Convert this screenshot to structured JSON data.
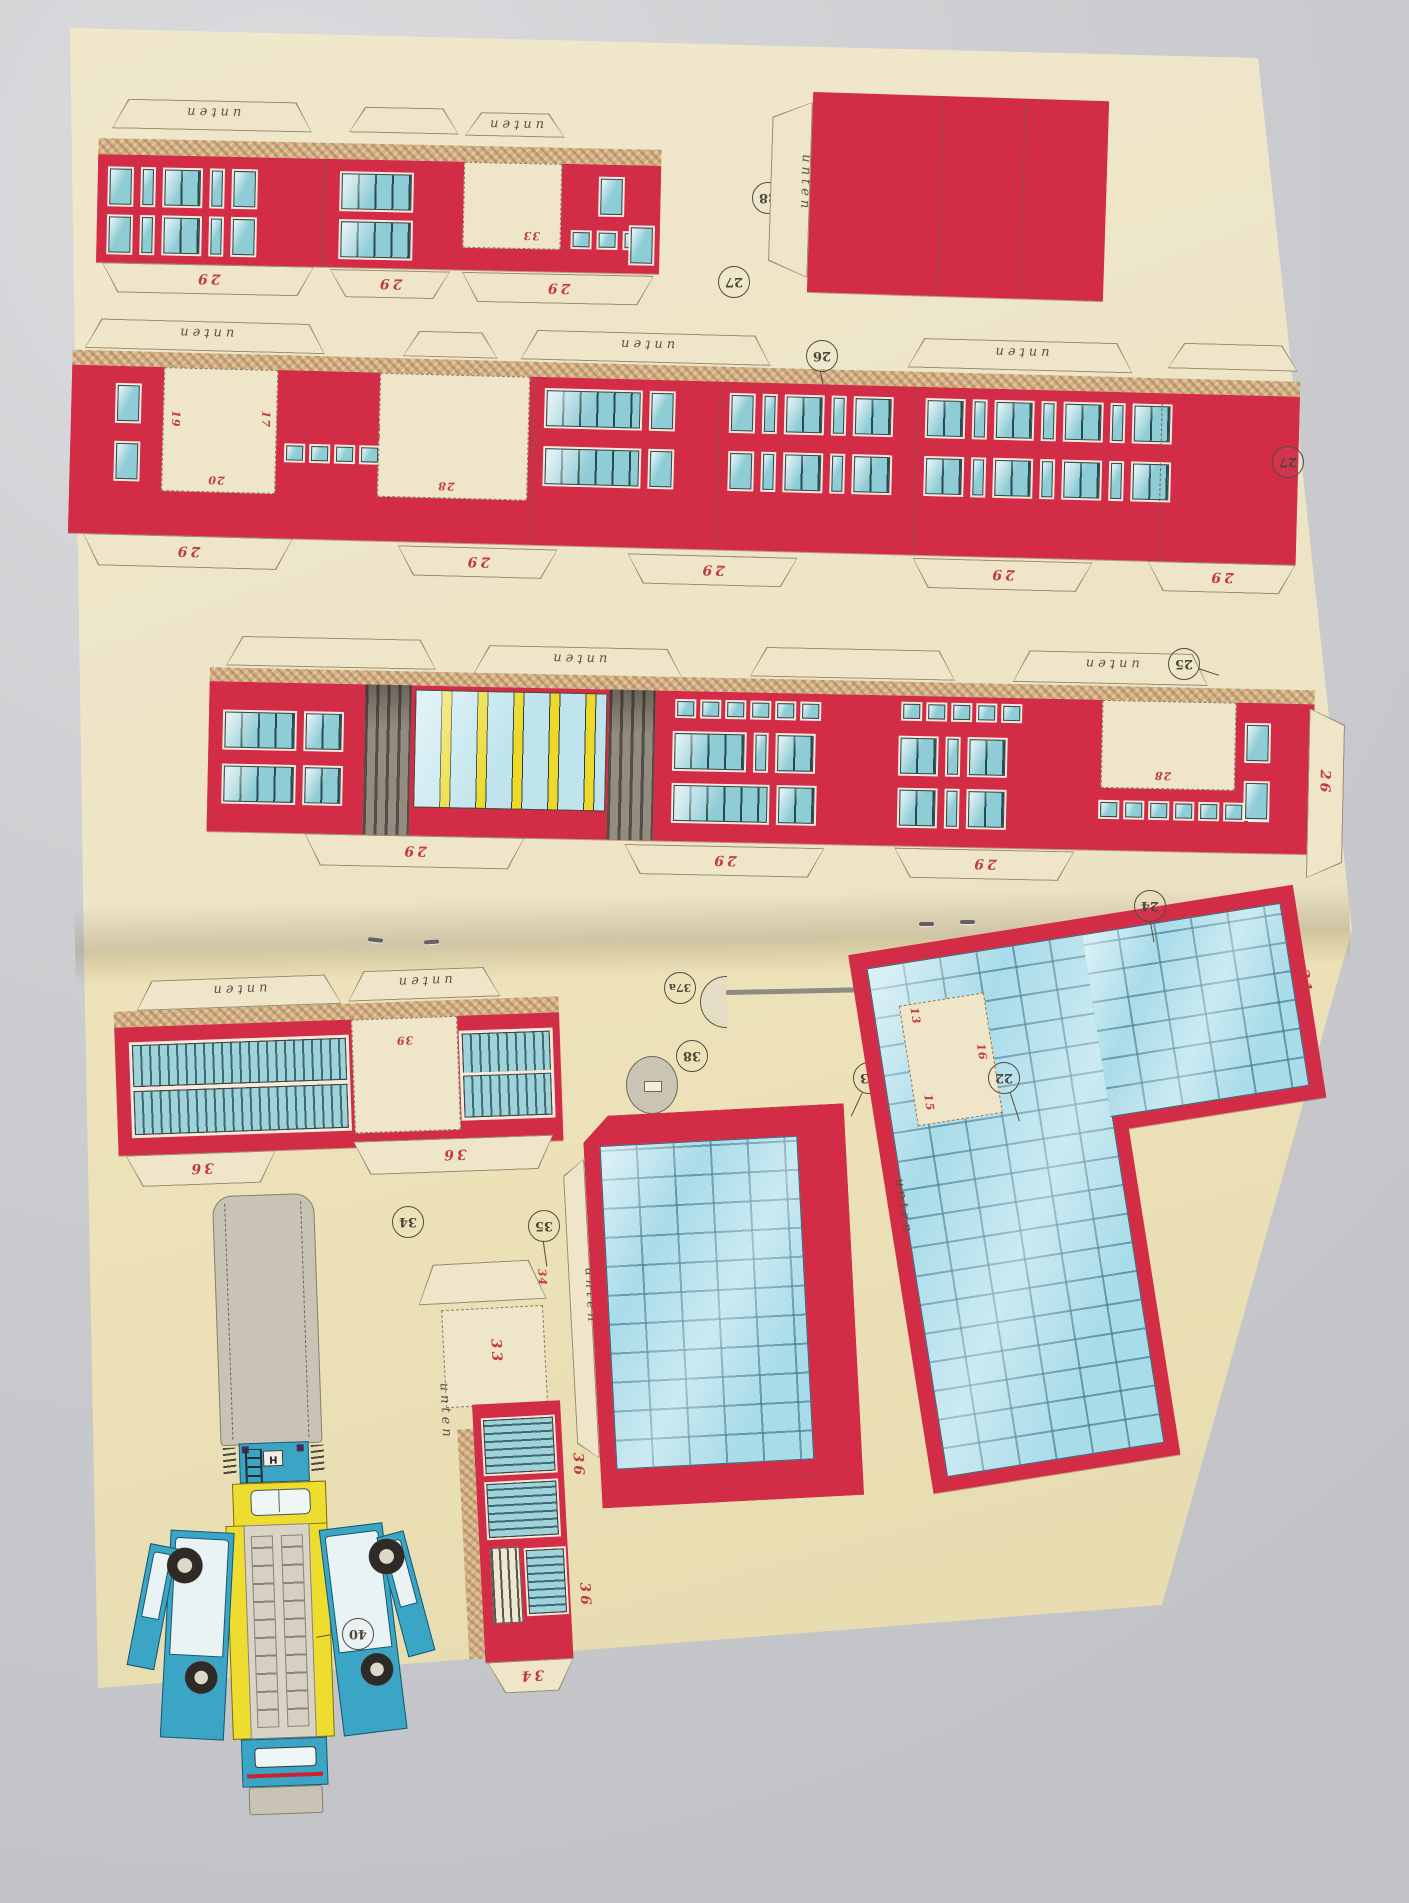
{
  "sheet": {
    "kind": "paper model cut-out sheet (booklet, two pages, stapled fold)",
    "labels": {
      "unten": "unten",
      "h_sign": "H",
      "n13": "13",
      "n15": "15",
      "n16": "16",
      "n17": "17",
      "n19": "19",
      "n20": "20",
      "n21": "21",
      "n22": "22",
      "n23": "23",
      "n24": "24",
      "n25": "25",
      "n26": "26",
      "n27": "27",
      "n28": "28",
      "n29": "29",
      "n33": "33",
      "n34": "34",
      "n35": "35",
      "n36": "36",
      "n37a": "37a",
      "n37A": "37A",
      "n37b": "37b",
      "n38": "38",
      "n39": "39",
      "n40": "40"
    },
    "colors": {
      "photo_background": "#cdced1",
      "paper_top": "#ece3c4",
      "paper_bottom": "#ede2b9",
      "building_red": "#d22c46",
      "window_glass": "#8fcdd6",
      "cork_strip": "#d6b183",
      "label_red": "#c23a40",
      "label_ink": "#4e463a",
      "glass_grid": "#a9dce9",
      "bus_blue": "#3aa5c5",
      "bus_yellow": "#eedc2e",
      "part_grey": "#c8c3b4",
      "disc_37b_red": "#d22c46"
    }
  }
}
